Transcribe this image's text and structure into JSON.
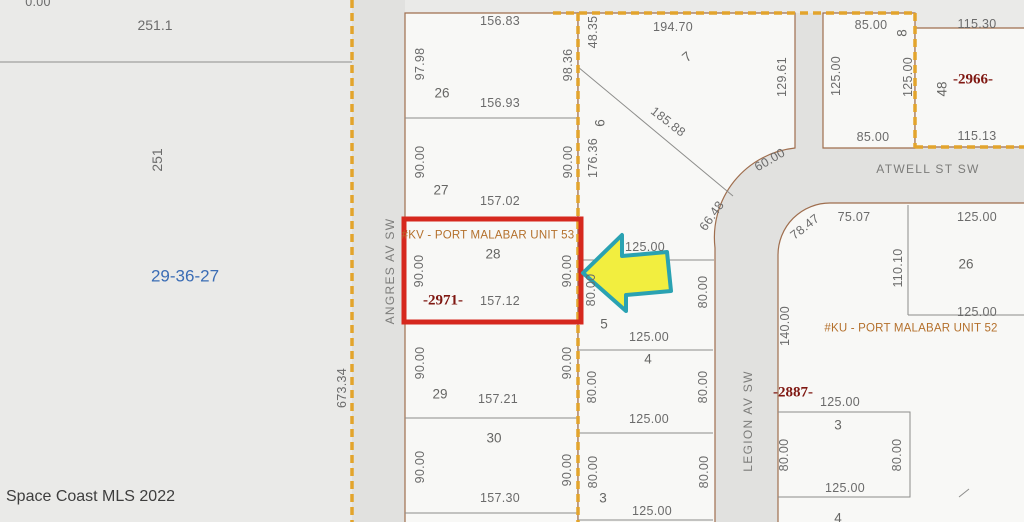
{
  "map": {
    "type": "plat-parcel-map",
    "highlight": {
      "unit": "#KV - PORT MALABAR UNIT 53",
      "lot": "28",
      "mls_number": "-2971-"
    },
    "colors": {
      "highlight_red": "#d6281e",
      "arrow_yellow": "#f2ee3f",
      "arrow_teal": "#2aa2b2",
      "boundary_orange": "#e3a42c",
      "section_blue": "#3b6db5",
      "mls_dark_red": "#7f1711",
      "unit_orange": "#b4702c"
    }
  },
  "labels": [
    {
      "t": "0.00",
      "x": 38,
      "y": 2,
      "r": 0,
      "c": "dim"
    },
    {
      "t": "251.1",
      "x": 155,
      "y": 25,
      "r": 0,
      "c": "big"
    },
    {
      "t": "251",
      "x": 157,
      "y": 160,
      "r": -90,
      "c": "big"
    },
    {
      "t": "29-36-27",
      "x": 185,
      "y": 276,
      "r": 0,
      "c": "sec"
    },
    {
      "t": "97.98",
      "x": 420,
      "y": 64,
      "r": -90,
      "c": "dim"
    },
    {
      "t": "156.83",
      "x": 500,
      "y": 21,
      "r": 0,
      "c": "dim"
    },
    {
      "t": "26",
      "x": 442,
      "y": 93,
      "r": 0,
      "c": "lot"
    },
    {
      "t": "156.93",
      "x": 500,
      "y": 103,
      "r": 0,
      "c": "dim"
    },
    {
      "t": "98.36",
      "x": 568,
      "y": 65,
      "r": -90,
      "c": "dim"
    },
    {
      "t": "48.35",
      "x": 593,
      "y": 32,
      "r": -90,
      "c": "dim"
    },
    {
      "t": "90.00",
      "x": 420,
      "y": 162,
      "r": -90,
      "c": "dim"
    },
    {
      "t": "27",
      "x": 441,
      "y": 190,
      "r": 0,
      "c": "lot"
    },
    {
      "t": "157.02",
      "x": 500,
      "y": 201,
      "r": 0,
      "c": "dim"
    },
    {
      "t": "90.00",
      "x": 568,
      "y": 162,
      "r": -90,
      "c": "dim"
    },
    {
      "t": "6",
      "x": 600,
      "y": 123,
      "r": -90,
      "c": "lot"
    },
    {
      "t": "176.36",
      "x": 593,
      "y": 158,
      "r": -90,
      "c": "dim"
    },
    {
      "t": "194.70",
      "x": 673,
      "y": 27,
      "r": 0,
      "c": "dim"
    },
    {
      "t": "7",
      "x": 687,
      "y": 57,
      "r": -40,
      "c": "lot"
    },
    {
      "t": "185.88",
      "x": 668,
      "y": 122,
      "r": 38,
      "c": "dim"
    },
    {
      "t": "129.61",
      "x": 782,
      "y": 77,
      "r": -90,
      "c": "dim"
    },
    {
      "t": "60.00",
      "x": 770,
      "y": 160,
      "r": -30,
      "c": "dim"
    },
    {
      "t": "125.00",
      "x": 836,
      "y": 76,
      "r": -90,
      "c": "dim"
    },
    {
      "t": "85.00",
      "x": 871,
      "y": 25,
      "r": 0,
      "c": "dim"
    },
    {
      "t": "8",
      "x": 902,
      "y": 33,
      "r": -90,
      "c": "lot"
    },
    {
      "t": "125.00",
      "x": 908,
      "y": 77,
      "r": -90,
      "c": "dim"
    },
    {
      "t": "85.00",
      "x": 873,
      "y": 137,
      "r": 0,
      "c": "dim"
    },
    {
      "t": "115.30",
      "x": 977,
      "y": 24,
      "r": 0,
      "c": "dim"
    },
    {
      "t": "-2966-",
      "x": 973,
      "y": 80,
      "r": 0,
      "c": "mls"
    },
    {
      "t": "48",
      "x": 942,
      "y": 89,
      "r": -90,
      "c": "lot"
    },
    {
      "t": "115.13",
      "x": 977,
      "y": 136,
      "r": 0,
      "c": "dim"
    },
    {
      "t": "ATWELL ST SW",
      "x": 928,
      "y": 169,
      "r": 0,
      "c": "street"
    },
    {
      "t": "78.47",
      "x": 805,
      "y": 227,
      "r": -38,
      "c": "dim"
    },
    {
      "t": "75.07",
      "x": 854,
      "y": 217,
      "r": 0,
      "c": "dim"
    },
    {
      "t": "125.00",
      "x": 977,
      "y": 217,
      "r": 0,
      "c": "dim"
    },
    {
      "t": "110.10",
      "x": 898,
      "y": 268,
      "r": -90,
      "c": "dim"
    },
    {
      "t": "26",
      "x": 966,
      "y": 264,
      "r": 0,
      "c": "lot"
    },
    {
      "t": "125.00",
      "x": 977,
      "y": 312,
      "r": 0,
      "c": "dim"
    },
    {
      "t": "#KU - PORT MALABAR UNIT 52",
      "x": 911,
      "y": 329,
      "r": 0,
      "c": "unit"
    },
    {
      "t": "140.00",
      "x": 785,
      "y": 326,
      "r": -90,
      "c": "dim"
    },
    {
      "t": "-2887-",
      "x": 793,
      "y": 393,
      "r": 0,
      "c": "mls"
    },
    {
      "t": "125.00",
      "x": 840,
      "y": 402,
      "r": 0,
      "c": "dim"
    },
    {
      "t": "3",
      "x": 838,
      "y": 425,
      "r": 0,
      "c": "lot"
    },
    {
      "t": "80.00",
      "x": 784,
      "y": 455,
      "r": -90,
      "c": "dim"
    },
    {
      "t": "80.00",
      "x": 897,
      "y": 455,
      "r": -90,
      "c": "dim"
    },
    {
      "t": "125.00",
      "x": 845,
      "y": 488,
      "r": 0,
      "c": "dim"
    },
    {
      "t": "4",
      "x": 838,
      "y": 518,
      "r": 0,
      "c": "lot"
    },
    {
      "t": "LEGION AV SW",
      "x": 748,
      "y": 421,
      "r": -90,
      "c": "street"
    },
    {
      "t": "66.48",
      "x": 712,
      "y": 216,
      "r": -55,
      "c": "dim"
    },
    {
      "t": "125.00",
      "x": 645,
      "y": 247,
      "r": 0,
      "c": "dim"
    },
    {
      "t": "80.00",
      "x": 591,
      "y": 290,
      "r": -90,
      "c": "dim"
    },
    {
      "t": "80.00",
      "x": 703,
      "y": 292,
      "r": -90,
      "c": "dim"
    },
    {
      "t": "5",
      "x": 604,
      "y": 324,
      "r": 0,
      "c": "lot"
    },
    {
      "t": "125.00",
      "x": 649,
      "y": 337,
      "r": 0,
      "c": "dim"
    },
    {
      "t": "4",
      "x": 648,
      "y": 359,
      "r": 0,
      "c": "lot"
    },
    {
      "t": "80.00",
      "x": 592,
      "y": 387,
      "r": -90,
      "c": "dim"
    },
    {
      "t": "80.00",
      "x": 703,
      "y": 387,
      "r": -90,
      "c": "dim"
    },
    {
      "t": "125.00",
      "x": 649,
      "y": 419,
      "r": 0,
      "c": "dim"
    },
    {
      "t": "80.00",
      "x": 593,
      "y": 472,
      "r": -90,
      "c": "dim"
    },
    {
      "t": "80.00",
      "x": 704,
      "y": 472,
      "r": -90,
      "c": "dim"
    },
    {
      "t": "3",
      "x": 603,
      "y": 498,
      "r": 0,
      "c": "lot"
    },
    {
      "t": "125.00",
      "x": 652,
      "y": 511,
      "r": 0,
      "c": "dim"
    },
    {
      "t": "#KV - PORT MALABAR UNIT 53",
      "x": 488,
      "y": 236,
      "r": 0,
      "c": "unit"
    },
    {
      "t": "28",
      "x": 493,
      "y": 254,
      "r": 0,
      "c": "lot"
    },
    {
      "t": "90.00",
      "x": 419,
      "y": 271,
      "r": -90,
      "c": "dim"
    },
    {
      "t": "90.00",
      "x": 567,
      "y": 271,
      "r": -90,
      "c": "dim"
    },
    {
      "t": "-2971-",
      "x": 443,
      "y": 301,
      "r": 0,
      "c": "mls"
    },
    {
      "t": "157.12",
      "x": 500,
      "y": 301,
      "r": 0,
      "c": "dim"
    },
    {
      "t": "90.00",
      "x": 420,
      "y": 363,
      "r": -90,
      "c": "dim"
    },
    {
      "t": "29",
      "x": 440,
      "y": 394,
      "r": 0,
      "c": "lot"
    },
    {
      "t": "157.21",
      "x": 498,
      "y": 399,
      "r": 0,
      "c": "dim"
    },
    {
      "t": "90.00",
      "x": 567,
      "y": 363,
      "r": -90,
      "c": "dim"
    },
    {
      "t": "30",
      "x": 494,
      "y": 438,
      "r": 0,
      "c": "lot"
    },
    {
      "t": "90.00",
      "x": 420,
      "y": 467,
      "r": -90,
      "c": "dim"
    },
    {
      "t": "90.00",
      "x": 567,
      "y": 470,
      "r": -90,
      "c": "dim"
    },
    {
      "t": "157.30",
      "x": 500,
      "y": 498,
      "r": 0,
      "c": "dim"
    },
    {
      "t": "673.34",
      "x": 342,
      "y": 388,
      "r": -90,
      "c": "dim"
    },
    {
      "t": "ANGRES AV SW",
      "x": 390,
      "y": 271,
      "r": -90,
      "c": "street"
    },
    {
      "t": "Space Coast MLS 2022",
      "x": 6,
      "y": 497,
      "r": 0,
      "c": "wm",
      "anchor": "left"
    }
  ]
}
